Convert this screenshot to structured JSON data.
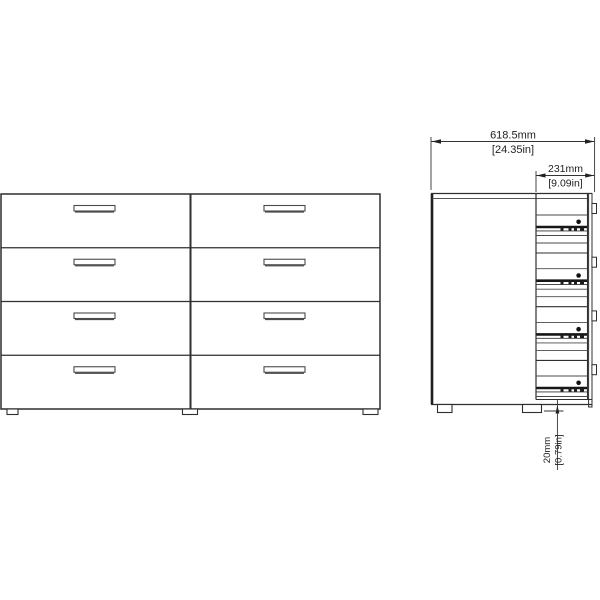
{
  "diagram": {
    "kind": "furniture-technical-drawing",
    "subject": "double-dresser-8-drawers",
    "colors": {
      "background": "#ffffff",
      "line": "#2f2f2f",
      "dark_line": "#161616",
      "dim_line": "#333333"
    },
    "front_view": {
      "drawer_rows": 4,
      "drawer_columns": 2,
      "handles": 8,
      "feet": 3
    },
    "side_view": {
      "drawer_slides": 4,
      "back_tabs": 4,
      "feet": 2
    },
    "dimensions": {
      "width": {
        "mm": "618.5mm",
        "inches": "[24.35in]"
      },
      "depth": {
        "mm": "231mm",
        "inches": "[9.09in]"
      },
      "clearance": {
        "mm": "20mm",
        "inches": "[0.79in]"
      }
    }
  }
}
